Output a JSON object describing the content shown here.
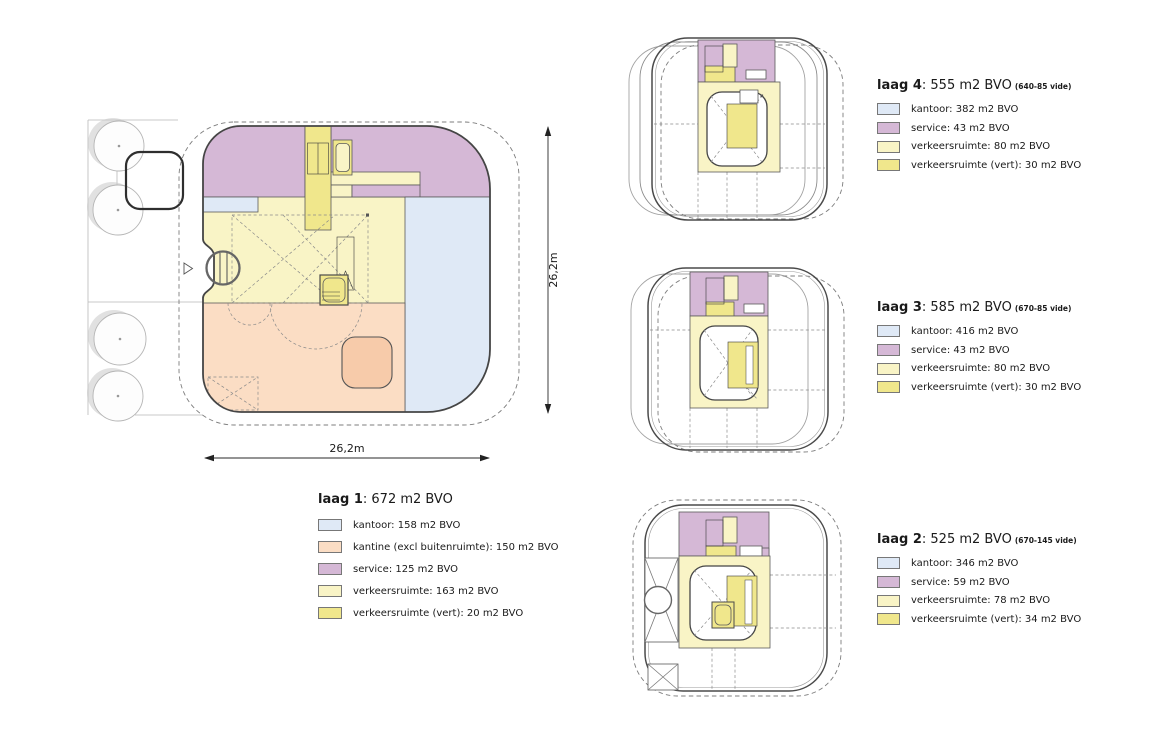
{
  "colors": {
    "kantoor": "#dfe9f6",
    "kantine": "#fbddc4",
    "kantine_accent": "#f7cbaa",
    "service": "#d5b8d6",
    "verkeersruimte": "#f9f4c6",
    "verkeersruimte_vert": "#f0e78c"
  },
  "dimensions": {
    "width_label": "26,2m",
    "height_label": "26,2m"
  },
  "legends": {
    "laag1": {
      "name": "laag 1",
      "total": ": 672 m2 BVO",
      "note": "",
      "items": [
        "kantoor: 158 m2 BVO",
        "kantine (excl buitenruimte): 150 m2 BVO",
        "service: 125 m2 BVO",
        "verkeersruimte: 163 m2 BVO",
        "verkeersruimte (vert): 20 m2 BVO"
      ]
    },
    "laag4": {
      "name": "laag 4",
      "total": ": 555 m2 BVO",
      "note": "(640-85 vide)",
      "items": [
        "kantoor: 382 m2 BVO",
        "service: 43 m2 BVO",
        "verkeersruimte: 80 m2 BVO",
        "verkeersruimte (vert): 30 m2 BVO"
      ]
    },
    "laag3": {
      "name": "laag 3",
      "total": ": 585 m2 BVO",
      "note": "(670-85 vide)",
      "items": [
        "kantoor: 416 m2 BVO",
        "service: 43 m2 BVO",
        "verkeersruimte: 80 m2 BVO",
        "verkeersruimte (vert): 30 m2 BVO"
      ]
    },
    "laag2": {
      "name": "laag 2",
      "total": ": 525 m2 BVO",
      "note": "(670-145 vide)",
      "items": [
        "kantoor: 346 m2 BVO",
        "service: 59 m2 BVO",
        "verkeersruimte: 78 m2 BVO",
        "verkeersruimte (vert): 34 m2 BVO"
      ]
    }
  }
}
